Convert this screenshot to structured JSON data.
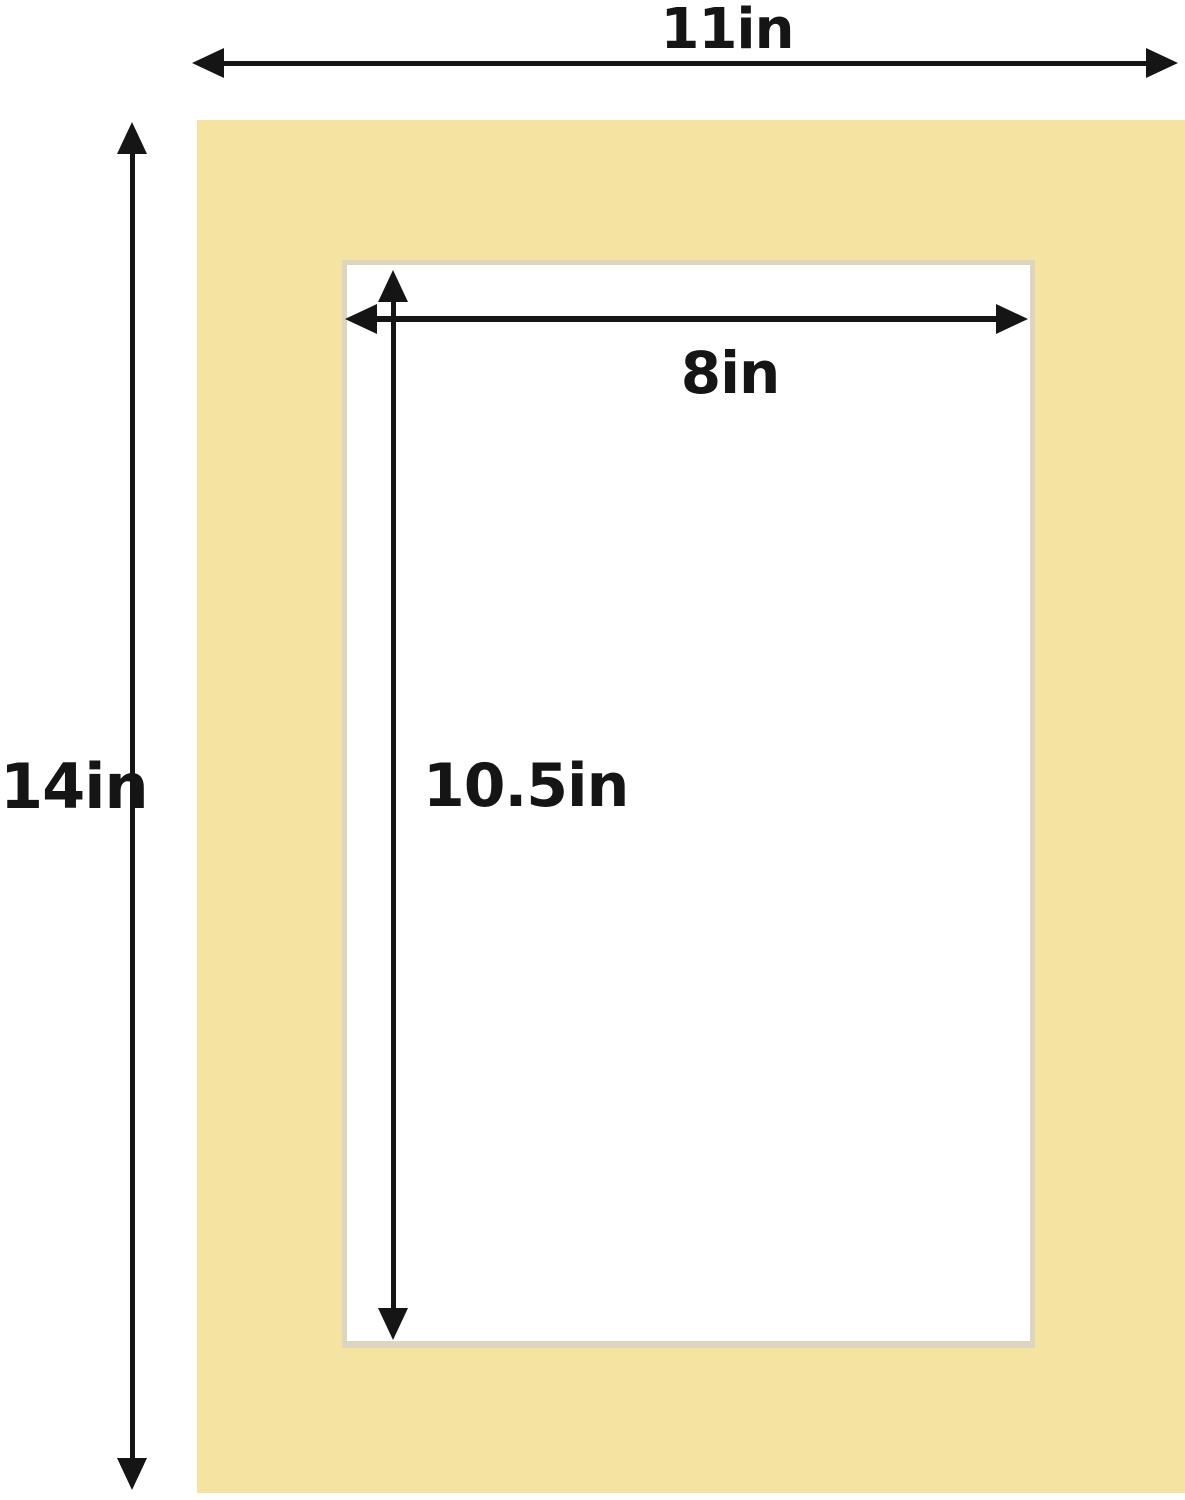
{
  "diagram": {
    "labels": {
      "outer_width": "11in",
      "outer_height": "14in",
      "opening_width": "8in",
      "opening_height": "10.5in"
    },
    "dimensions_in": {
      "outer_width": 11,
      "outer_height": 14,
      "opening_width": 8,
      "opening_height": 10.5
    },
    "colors": {
      "mat": "#F5E3A1",
      "bevel": "#DDD5C0",
      "arrow": "#151515",
      "background": "#FFFFFF"
    }
  }
}
